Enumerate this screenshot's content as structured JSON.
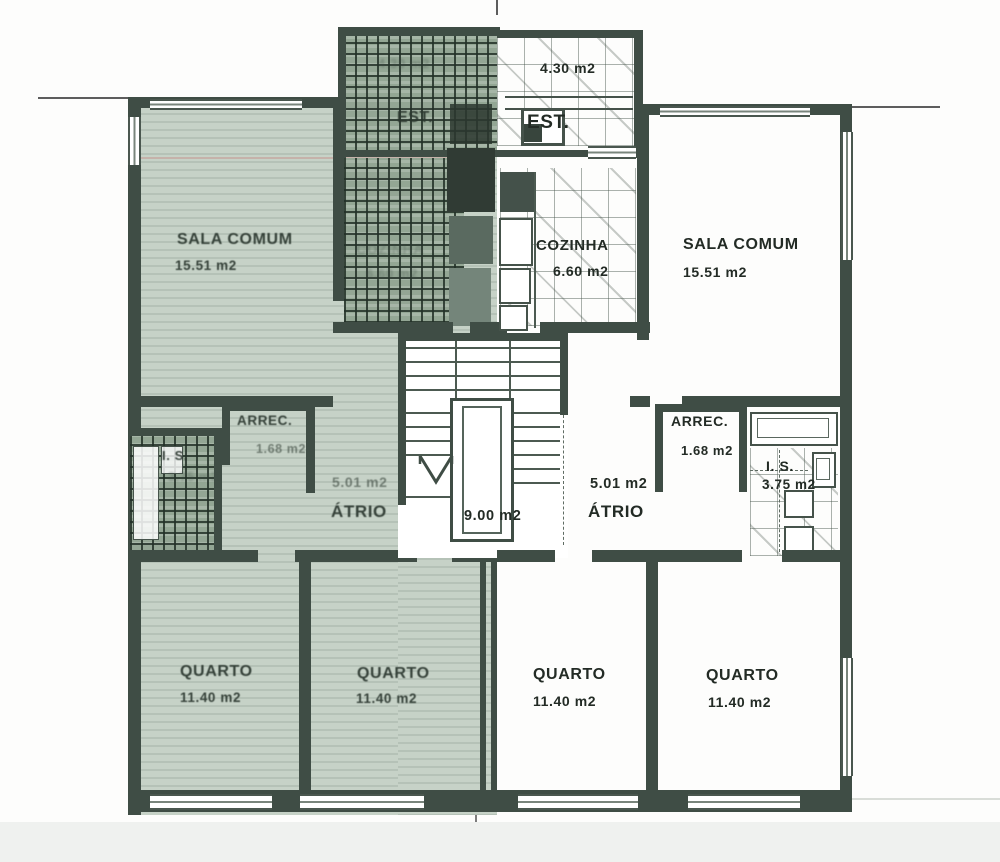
{
  "left": {
    "sala": {
      "name": "SALA COMUM",
      "area": "15.51 m2"
    },
    "cozinha": {
      "name": "COZINHA",
      "area": "6.60 m2"
    },
    "est": {
      "name": "EST.",
      "area": "4.30 m2"
    },
    "arrec": {
      "name": "ARREC.",
      "area": "1.68 m2"
    },
    "is": {
      "name": "I. S.",
      "area": "3.75 m2"
    },
    "atrio": {
      "name": "ÁTRIO",
      "area": "5.01 m2"
    },
    "quarto1": {
      "name": "QUARTO",
      "area": "11.40 m2"
    },
    "quarto2": {
      "name": "QUARTO",
      "area": "11.40 m2"
    }
  },
  "right": {
    "sala": {
      "name": "SALA COMUM",
      "area": "15.51 m2"
    },
    "cozinha": {
      "name": "COZINHA",
      "area": "6.60 m2"
    },
    "est": {
      "name": "EST.",
      "area": "4.30 m2"
    },
    "arrec": {
      "name": "ARREC.",
      "area": "1.68 m2"
    },
    "is": {
      "name": "I. S.",
      "area": "3.75 m2"
    },
    "atrio": {
      "name": "ÁTRIO",
      "area": "5.01 m2"
    },
    "quarto1": {
      "name": "QUARTO",
      "area": "11.40 m2"
    },
    "quarto2": {
      "name": "QUARTO",
      "area": "11.40 m2"
    }
  },
  "stair": {
    "hall_area": "9.00 m2"
  },
  "colors": {
    "highlight": "#c6d2c7",
    "wall": "#3f4d45",
    "paper": "#fdfdfc"
  }
}
